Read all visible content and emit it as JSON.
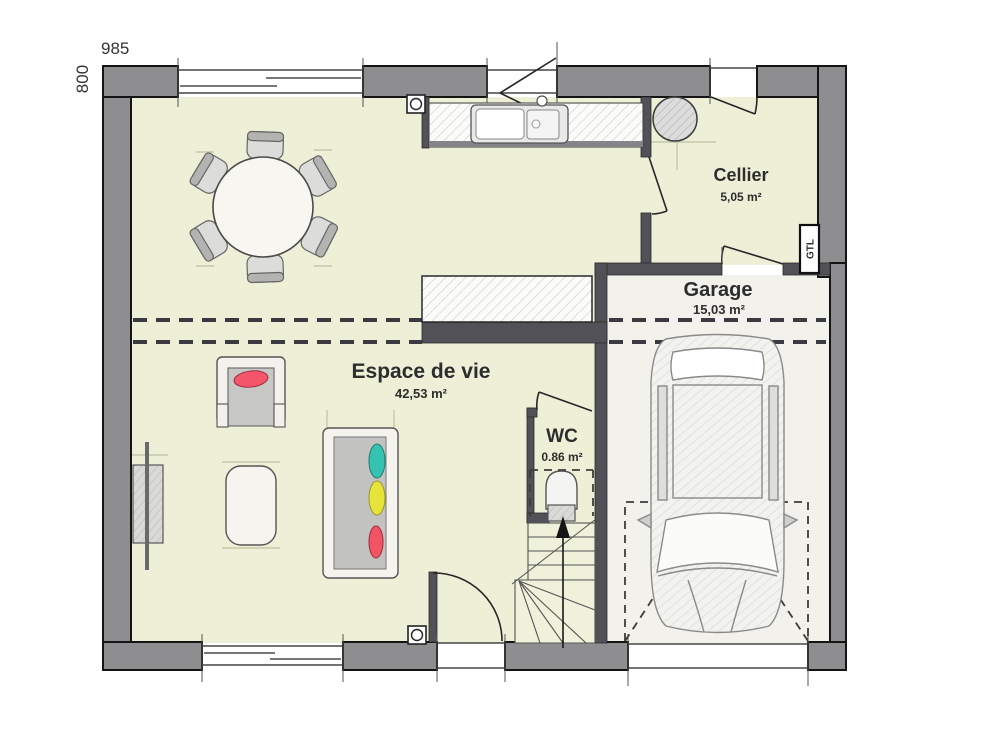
{
  "plan": {
    "overall_width_cm": "985",
    "overall_height_cm": "800",
    "rooms": [
      {
        "name": "Cellier",
        "area": "5,05 m²"
      },
      {
        "name": "Garage",
        "area": "15,03 m²"
      },
      {
        "name": "Espace de vie",
        "area": "42,53 m²"
      },
      {
        "name": "WC",
        "area": "0.86 m²"
      }
    ],
    "labels": {
      "gtl": "GTL"
    },
    "colors": {
      "floor": "#edefd6",
      "garage_floor": "#f2f1ec",
      "exterior_wall": "#8e8e90",
      "partition_wall": "#515157",
      "wall_outline": "#141414",
      "cushion_teal": "#35c2b1",
      "cushion_yellow": "#e6e33b",
      "cushion_red": "#f25365",
      "armchair_pillow_red": "#f4556b"
    }
  }
}
